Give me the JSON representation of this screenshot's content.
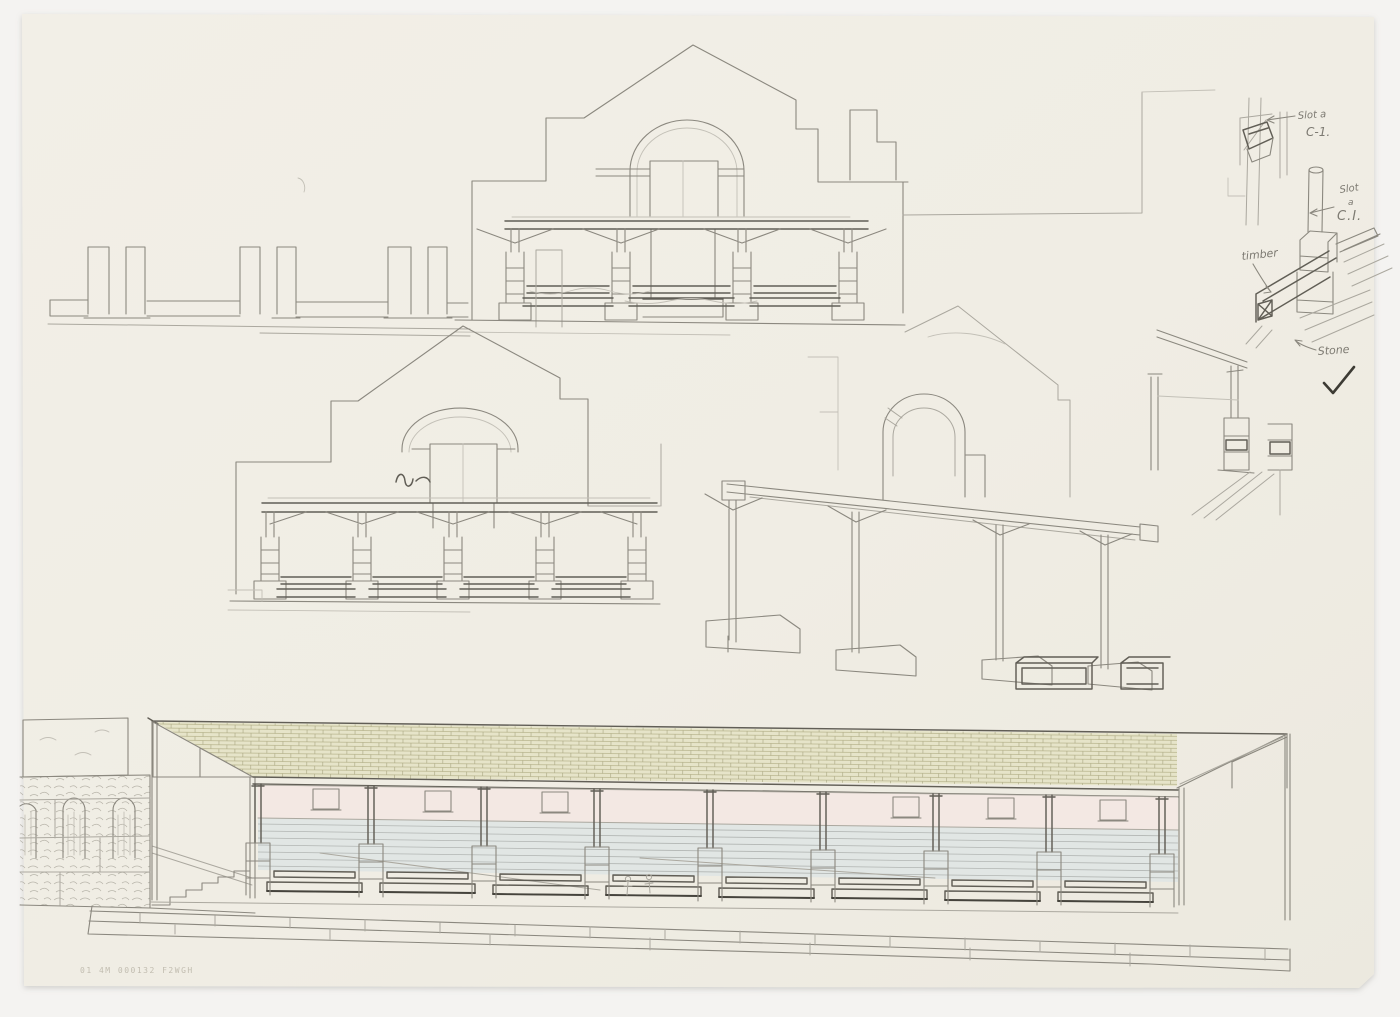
{
  "annotations": {
    "upper_detail": {
      "line1": "Slot a",
      "line2": "C-1."
    },
    "lower_detail": {
      "line1": "Slot",
      "line2": "a",
      "line3": "C.I."
    },
    "timber": "timber",
    "stone": "Stone"
  },
  "icons": {
    "checkmark": "✓"
  },
  "stamp": {
    "text": "01 4M 000132 F2WGH"
  },
  "colors": {
    "background": "#f4f3f1",
    "paper": "#f1eee5",
    "graphite_light": "#aba89f",
    "graphite_mid": "#8b887f",
    "graphite_dark": "#615e56",
    "graphite_heavy": "#45433c",
    "roof_tile_fill": "#e6e4c9",
    "roof_tile_stroke": "#b0ad82",
    "wall_pink": "#f3e8e3",
    "wall_blue_grey": "#e1e6e4"
  }
}
